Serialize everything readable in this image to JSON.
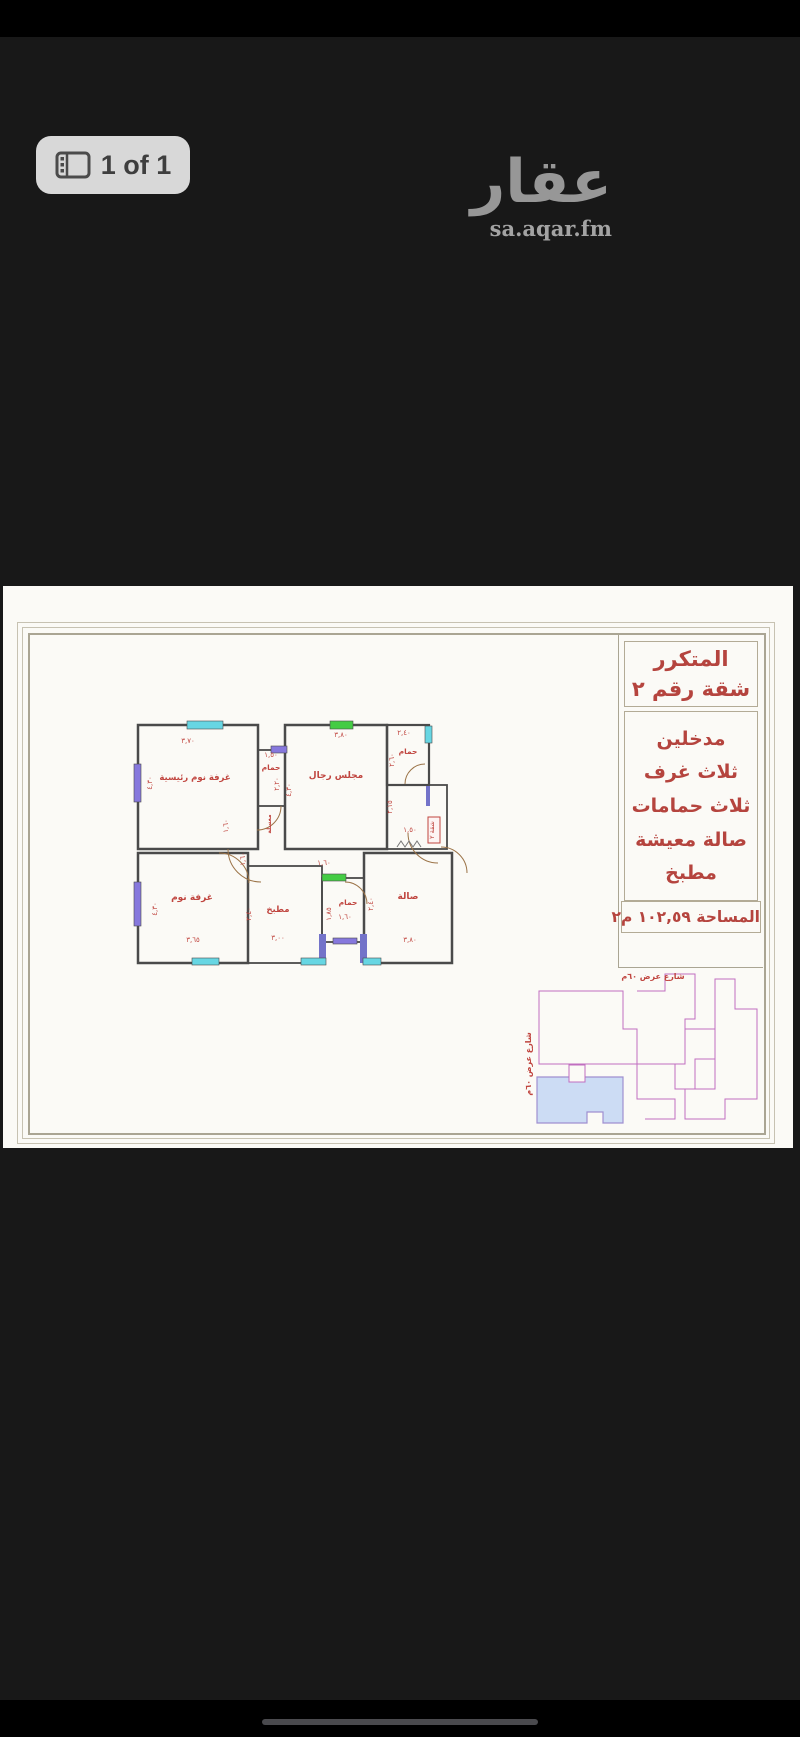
{
  "viewer": {
    "badge_label": "1 of 1",
    "badge_icon": "gallery-icon"
  },
  "brand": {
    "logo_text": "عقار",
    "domain": "sa.aqar.fm"
  },
  "title_block": {
    "project": "المتكرر",
    "unit": "شقة رقم ٢",
    "features": [
      "مدخلين",
      "ثلاث غرف",
      "ثلاث حمامات",
      "صالة معيشة",
      "مطبخ"
    ],
    "area": "المساحة ١٠٢,٥٩ م٢"
  },
  "floor_plan": {
    "rooms": {
      "master_bedroom": "غرفة نوم رئيسية",
      "bathroom": "حمام",
      "mens_majlis": "مجلس رجال",
      "bedroom": "غرفة نوم",
      "kitchen": "مطبخ",
      "hall": "صالة",
      "washbasin": "مغسلة"
    },
    "unit_tag": "شقة ٢",
    "dims": {
      "d370": "٣,٧٠",
      "d150": "١,٥٠",
      "d380": "٣,٨٠",
      "d240": "٢,٤٠",
      "d430": "٤,٣٠",
      "d220": "٢,٢٠",
      "d260": "٢,٦٠",
      "d215": "٢,١٥",
      "d160": "١,٦٠",
      "d365": "٣,٦٥",
      "d300": "٣,٠٠",
      "d185": "١,٨٥"
    }
  },
  "site_plan": {
    "street_top": "شارع عرض ٦٠م",
    "street_left": "شارع عرض ٦٠م"
  },
  "colors": {
    "accent_red": "#b5443e",
    "window_cyan": "#67d6e3",
    "window_green": "#44cc44",
    "window_purple": "#8678dd",
    "site_magenta": "#c06ec0",
    "badge_bg": "#d8d8d8",
    "sheet_bg": "#fbfaf6"
  }
}
